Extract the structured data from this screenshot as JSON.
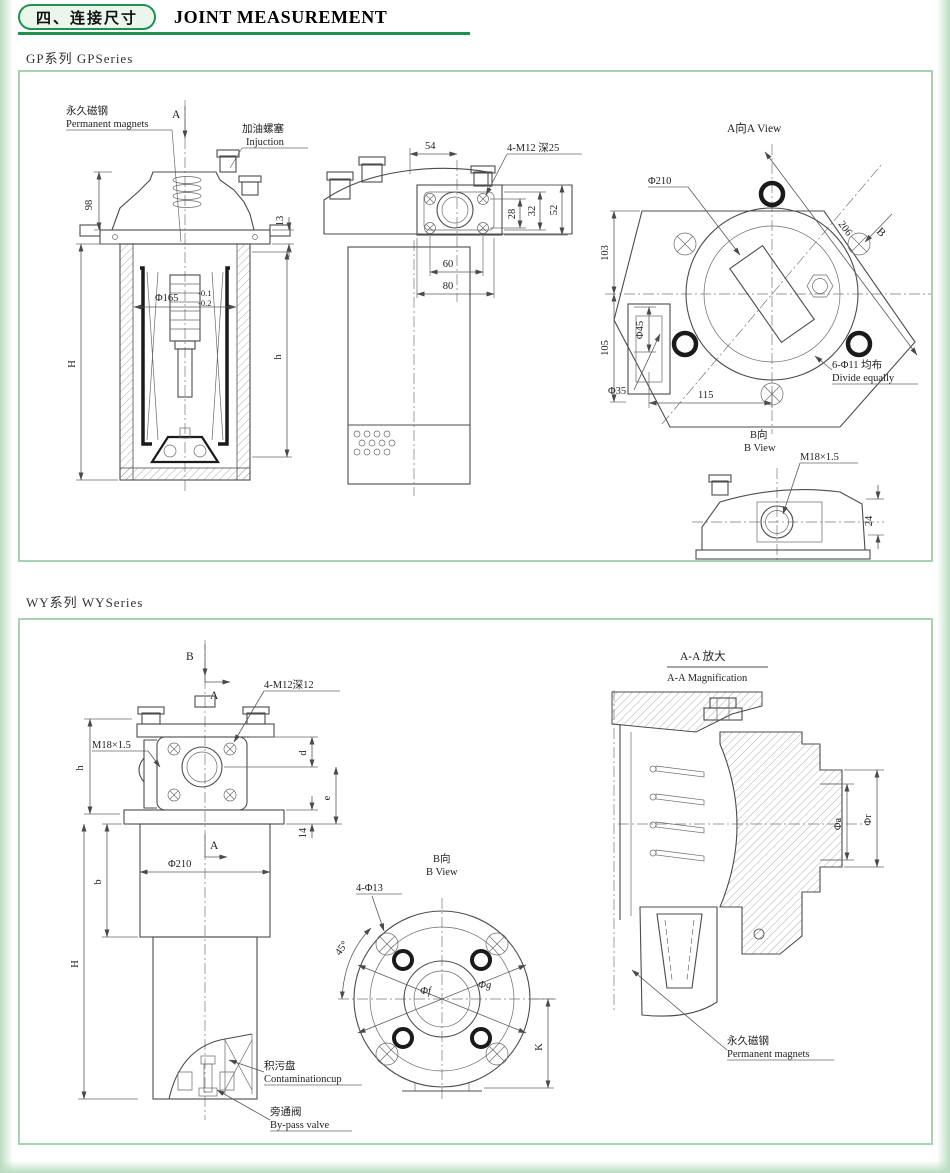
{
  "header": {
    "badge": "四、连接尺寸",
    "title": "JOINT MEASUREMENT"
  },
  "gp": {
    "series_label": "GP系列  GPSeries",
    "front": {
      "magnets_cn": "永久磁钢",
      "magnets_en": "Permanent magnets",
      "injection_cn": "加油螺塞",
      "injection_en": "Injuction",
      "view_a": "A",
      "d98": "98",
      "d13": "13",
      "d165": "Φ165",
      "d165_tol_hi": "-0.1",
      "d165_tol_lo": "-0.2",
      "dH": "H",
      "dh": "h"
    },
    "side": {
      "d54": "54",
      "bolts": "4-M12 深25",
      "d28": "28",
      "d32": "32",
      "d52": "52",
      "d60": "60",
      "d80": "80"
    },
    "aview": {
      "title": "A向A View",
      "d210": "Φ210",
      "d206": "206",
      "d103": "103",
      "d105": "105",
      "d45": "Φ45",
      "d35": "Φ35",
      "d115": "115",
      "holes_cn": "6-Φ11 均布",
      "holes_en": "Divide equally",
      "view_b": "B"
    },
    "bview": {
      "title_cn": "B向",
      "title_en": "B View",
      "thread": "M18×1.5",
      "d24": "24"
    }
  },
  "wy": {
    "series_label": "WY系列  WYSeries",
    "front": {
      "view_b": "B",
      "view_a_top": "A",
      "view_a_mid": "A",
      "bolts": "4-M12深12",
      "thread": "M18×1.5",
      "dh": "h",
      "dd": "d",
      "de": "e",
      "d14": "14",
      "db": "b",
      "d210": "Φ210",
      "dH": "H",
      "cup_cn": "积污盘",
      "cup_en": "Contaminationcup",
      "valve_cn": "旁通阀",
      "valve_en": "By-pass valve"
    },
    "bview": {
      "title_cn": "B向",
      "title_en": "B View",
      "holes": "4-Φ13",
      "angle": "45°",
      "df": "Φf",
      "dg": "Φg",
      "dK": "K"
    },
    "aa": {
      "title_cn": "A-A  放大",
      "title_en": "A-A Magnification",
      "da": "Φa",
      "dr": "Φr",
      "magnets_cn": "永久磁钢",
      "magnets_en": "Permanent magnets"
    }
  }
}
